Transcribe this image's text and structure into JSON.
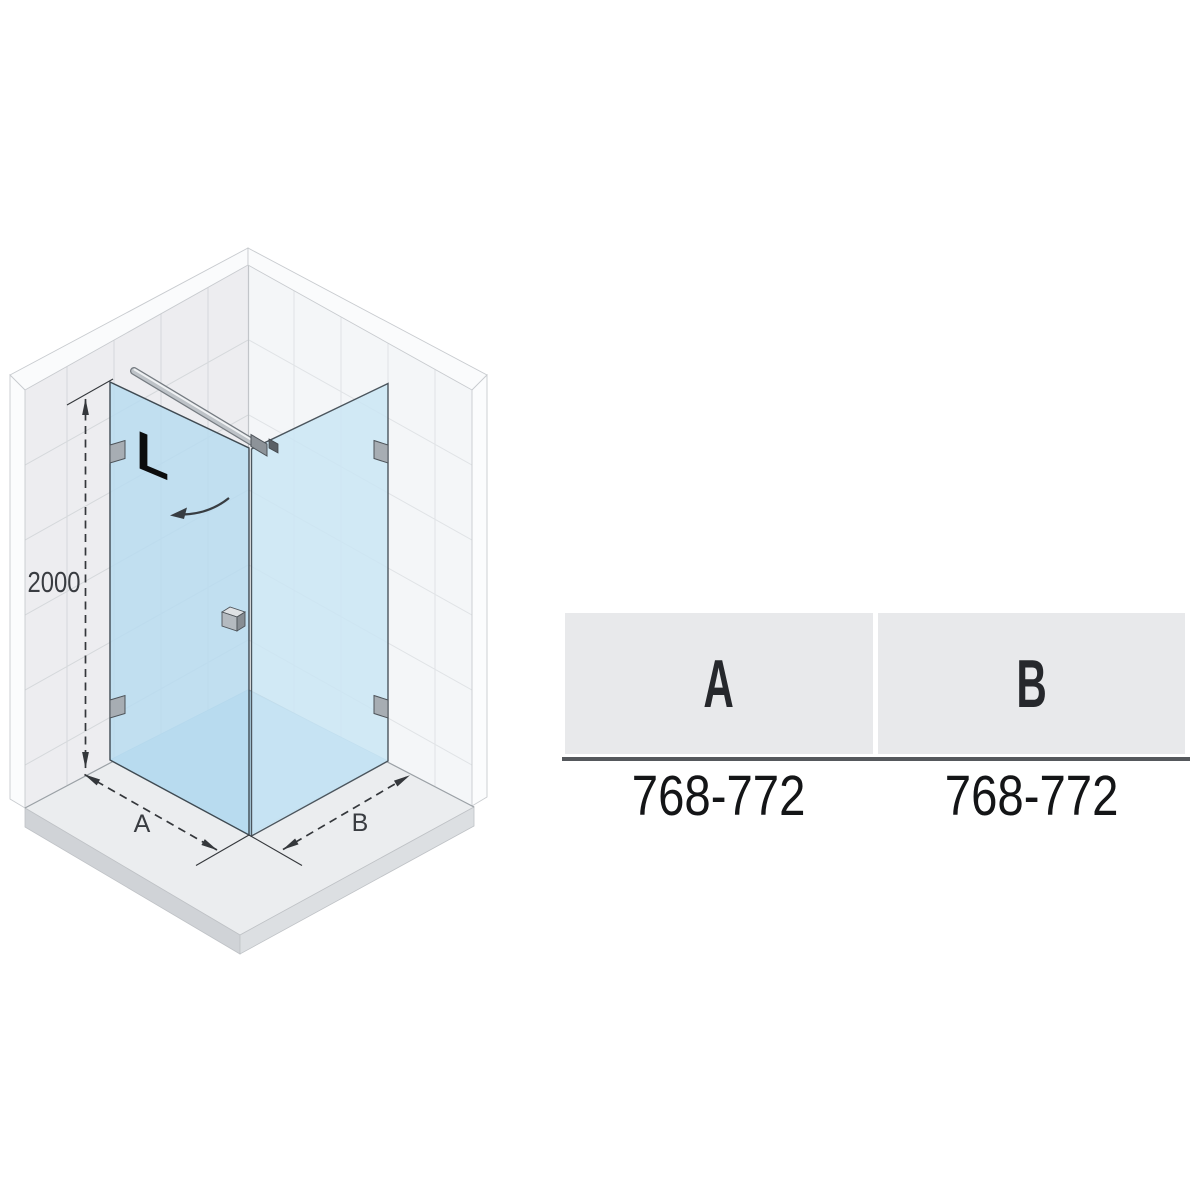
{
  "drawing": {
    "height_dimension": "2000",
    "width_a_label": "A",
    "width_b_label": "B",
    "orientation_mark": "L",
    "icons": {
      "door_swing_arrow": "curved-arrow-left",
      "height_dimension_arrows": "double-ended-dashed-dimension",
      "width_dimension_arrows": "double-ended-dashed-dimension"
    },
    "colors": {
      "door_glass": "#b9dcf0",
      "side_panel_glass": "#c9e5f4",
      "shower_tray": "#b5d8eb",
      "wall_left": "#ededf0",
      "wall_right": "#f4f6f8",
      "dimension_lines": "#34373b"
    }
  },
  "table": {
    "columns": [
      {
        "header": "A",
        "value": "768-772"
      },
      {
        "header": "B",
        "value": "768-772"
      }
    ],
    "header_background": "#e8e9eb",
    "rule_color": "#55585c"
  }
}
